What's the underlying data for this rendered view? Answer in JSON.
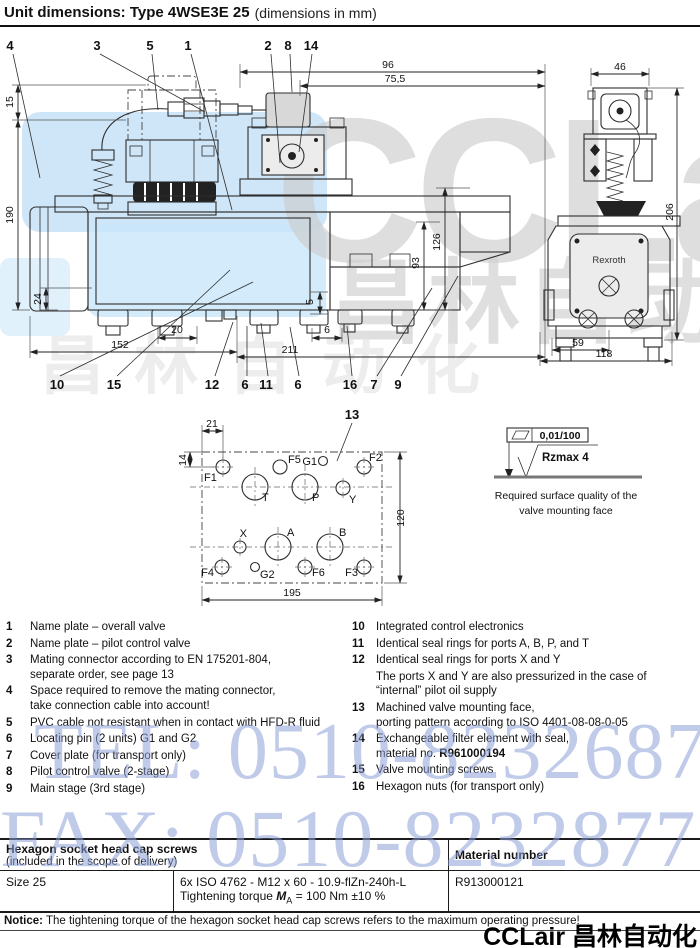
{
  "header": {
    "title": "Unit dimensions: Type 4WSE3E 25",
    "subtitle": "(dimensions in mm)"
  },
  "side_view": {
    "callouts_top": {
      "c4": "4",
      "c3": "3",
      "c5": "5",
      "c1": "1",
      "c2": "2",
      "c8": "8",
      "c14": "14"
    },
    "callouts_bottom": [
      "10",
      "15",
      "12",
      "6",
      "11",
      "6",
      "16",
      "7",
      "9"
    ],
    "dims": {
      "d96": "96",
      "d75_5": "75,5",
      "d15": "15",
      "d190": "190",
      "d24": "24",
      "d126": "126",
      "d93": "93",
      "d152": "152",
      "d20": "20",
      "d211": "211",
      "d5": "5",
      "d6": "6"
    }
  },
  "front_view": {
    "brand": "Rexroth",
    "dims": {
      "d46": "46",
      "d206": "206",
      "d59": "59",
      "d118": "118"
    }
  },
  "porting": {
    "callout": "13",
    "dims": {
      "d21": "21",
      "d14": "14",
      "d120": "120",
      "d195": "195"
    },
    "labels": {
      "f1": "F1",
      "f2": "F2",
      "f3": "F3",
      "f4": "F4",
      "f5": "F5",
      "f6": "F6",
      "g1": "G1",
      "g2": "G2",
      "t": "T",
      "p": "P",
      "y": "Y",
      "x": "X",
      "a": "A",
      "b": "B"
    }
  },
  "surface": {
    "flatness": "0,01/100",
    "roughness": "Rzmax 4",
    "caption1": "Required surface quality of the",
    "caption2": "valve mounting face"
  },
  "legend_left": [
    {
      "no": "1",
      "text": "Name plate – overall valve"
    },
    {
      "no": "2",
      "text": "Name plate – pilot control valve"
    },
    {
      "no": "3",
      "text": "Mating connector according to EN 175201-804,\nseparate order, see page 13"
    },
    {
      "no": "4",
      "text": "Space required to remove the mating connector,\ntake connection cable into account!"
    },
    {
      "no": "5",
      "text": "PVC cable not resistant when in contact with HFD-R fluid"
    },
    {
      "no": "6",
      "text": "Locating pin (2 units) G1 and G2"
    },
    {
      "no": "7",
      "text": "Cover plate (for transport only)"
    },
    {
      "no": "8",
      "text": "Pilot control valve (2-stage)"
    },
    {
      "no": "9",
      "text": "Main stage (3rd stage)"
    }
  ],
  "legend_right": [
    {
      "no": "10",
      "text": "Integrated control electronics"
    },
    {
      "no": "11",
      "text": "Identical seal rings for ports A, B, P, and T"
    },
    {
      "no": "12",
      "text": "Identical seal rings for ports X and Y"
    },
    {
      "no": "",
      "text": "The ports X and Y are also pressurized in the case of\n“internal” pilot oil supply"
    },
    {
      "no": "13",
      "text": "Machined valve mounting face,\nporting pattern according to ISO 4401-08-08-0-05"
    },
    {
      "no": "14",
      "text": "Exchangeable filter element with seal,\nmaterial no. ",
      "bold": "R961000194"
    },
    {
      "no": "15",
      "text": "Valve mounting screws"
    },
    {
      "no": "16",
      "text": "Hexagon nuts (for transport only)"
    }
  ],
  "table": {
    "header": {
      "col1_title": "Hexagon socket head cap screws",
      "col1_sub": "(included in the scope of delivery)",
      "col2": "Material number"
    },
    "row": {
      "size": "Size 25",
      "spec": "6x ISO 4762 - M12 x 60 - 10.9-flZn-240h-L",
      "torque_prefix": "Tightening torque ",
      "torque_sym": "M",
      "torque_sub": "A",
      "torque_suffix": " = 100 Nm ±10 %",
      "material": "R913000121"
    }
  },
  "notice": {
    "label": "Notice:",
    "text": " The tightening torque of the hexagon socket head cap screws refers to the maximum operating pressure!"
  },
  "watermarks": {
    "tel": "TEL: 0510-82326871",
    "fax": "FAX: 0510-82328771",
    "brand": "CCLair",
    "brand_cn": "昌林自动化",
    "footer": "CCLair 昌林自动化",
    "accent_blue": "#9fb0dd",
    "accent_gray": "#d2d2d2",
    "patch_blue": "#cfe4f7"
  }
}
